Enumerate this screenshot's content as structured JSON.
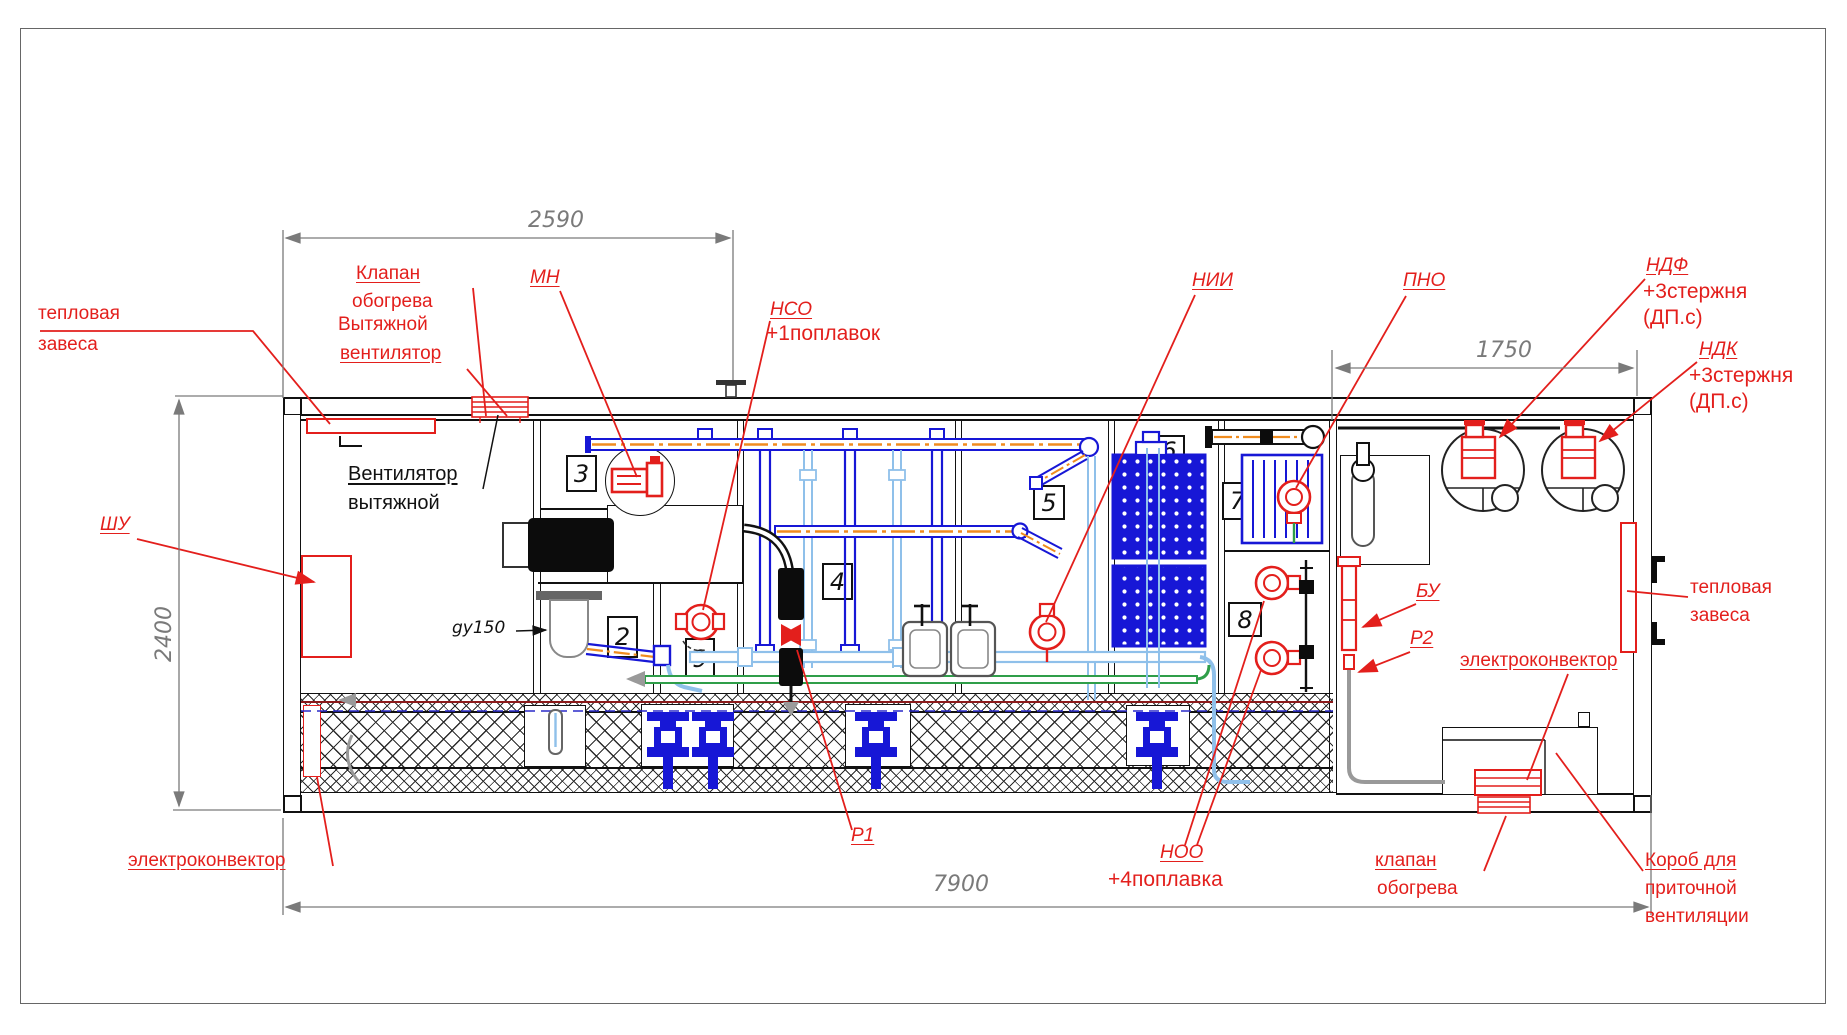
{
  "dimensions": {
    "top_span": "2590",
    "height": "2400",
    "right_span": "1750",
    "length": "7900"
  },
  "item_numbers": {
    "n2": "2",
    "n3": "3",
    "n4": "4",
    "n5": "5",
    "n6": "6",
    "n7": "7",
    "n8": "8",
    "n9": "9"
  },
  "labels": {
    "heat_curtain_left_1": "тепловая",
    "heat_curtain_left_2": "завеса",
    "heating_valve_top_1": "Клапан",
    "heating_valve_top_2": "обогрева",
    "exhaust_fan_red_1": "Вытяжной",
    "exhaust_fan_red_2": "вентилятор",
    "exhaust_fan_black_1": "Вентилятор",
    "exhaust_fan_black_2": "вытяжной",
    "mn": "МН",
    "nso": "НСО",
    "nso_note": "+1поплавок",
    "nii": "НИИ",
    "pno": "ПНО",
    "ndf": "НДФ",
    "ndf_note1": "+3стержня",
    "ndf_note2": "(ДП.с)",
    "ndk": "НДК",
    "ndk_note1": "+3стержня",
    "ndk_note2": "(ДП.с)",
    "shu": "ШУ",
    "gy150": "gy150",
    "bu": "БУ",
    "p2": "Р2",
    "p1": "Р1",
    "noo": "НОО",
    "noo_note": "+4поплавка",
    "heat_curtain_right_1": "тепловая",
    "heat_curtain_right_2": "завеса",
    "electroconvector_right": "электроконвектор",
    "electroconvector_left": "электроконвектор",
    "heating_valve_bottom_1": "клапан",
    "heating_valve_bottom_2": "обогрева",
    "supply_duct_1": "Короб для",
    "supply_duct_2": "приточной",
    "supply_duct_3": "вентиляции"
  },
  "colors": {
    "red": "#e31f1c",
    "blue": "#1717d6",
    "light_blue": "#8fc0ea",
    "orange": "#f08c1e",
    "green": "#2f9e49",
    "dim_grey": "#7a7a7a"
  }
}
